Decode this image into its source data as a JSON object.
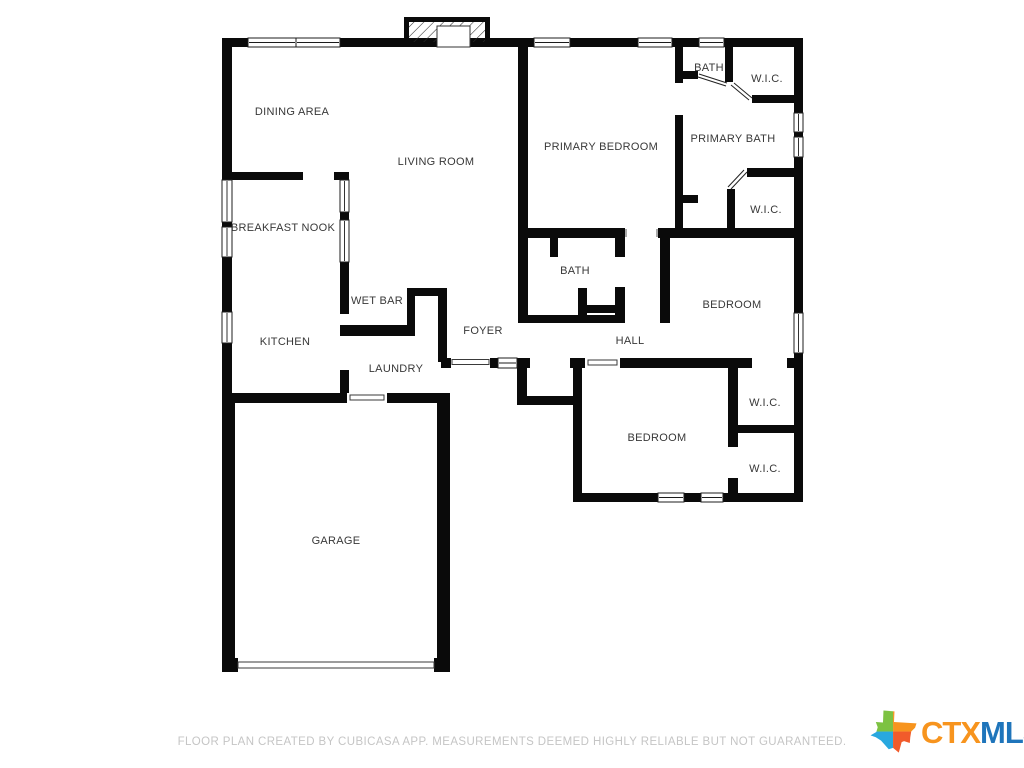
{
  "floor_plan": {
    "wall_color": "#0a0a0a",
    "rooms": [
      {
        "id": "dining-area",
        "label": "DINING AREA"
      },
      {
        "id": "living-room",
        "label": "LIVING ROOM"
      },
      {
        "id": "primary-bedroom",
        "label": "PRIMARY BEDROOM"
      },
      {
        "id": "bath-primary",
        "label": "BATH"
      },
      {
        "id": "wic-primary-north",
        "label": "W.I.C."
      },
      {
        "id": "primary-bath",
        "label": "PRIMARY BATH"
      },
      {
        "id": "wic-primary-south",
        "label": "W.I.C."
      },
      {
        "id": "breakfast-nook",
        "label": "BREAKFAST NOOK"
      },
      {
        "id": "bath-hall",
        "label": "BATH"
      },
      {
        "id": "bedroom-middle",
        "label": "BEDROOM"
      },
      {
        "id": "wet-bar",
        "label": "WET BAR"
      },
      {
        "id": "kitchen",
        "label": "KITCHEN"
      },
      {
        "id": "foyer",
        "label": "FOYER"
      },
      {
        "id": "hall",
        "label": "HALL"
      },
      {
        "id": "laundry",
        "label": "LAUNDRY"
      },
      {
        "id": "wic-bedroom-north",
        "label": "W.I.C."
      },
      {
        "id": "bedroom-south",
        "label": "BEDROOM"
      },
      {
        "id": "wic-bedroom-south",
        "label": "W.I.C."
      },
      {
        "id": "garage",
        "label": "GARAGE"
      }
    ]
  },
  "footer": {
    "disclaimer": "FLOOR PLAN CREATED BY CUBICASA APP. MEASUREMENTS DEEMED HIGHLY RELIABLE BUT NOT GUARANTEED.",
    "color": "#c5c5c5"
  },
  "logo": {
    "text_primary": "CTX",
    "text_secondary": "MLS",
    "primary_color": "#F7941E",
    "secondary_color": "#1F75BB",
    "texas_colors": {
      "top_left": "#7DC242",
      "top_right": "#F7941E",
      "bottom_left": "#29A8DF",
      "bottom_right": "#F15B2B"
    }
  }
}
